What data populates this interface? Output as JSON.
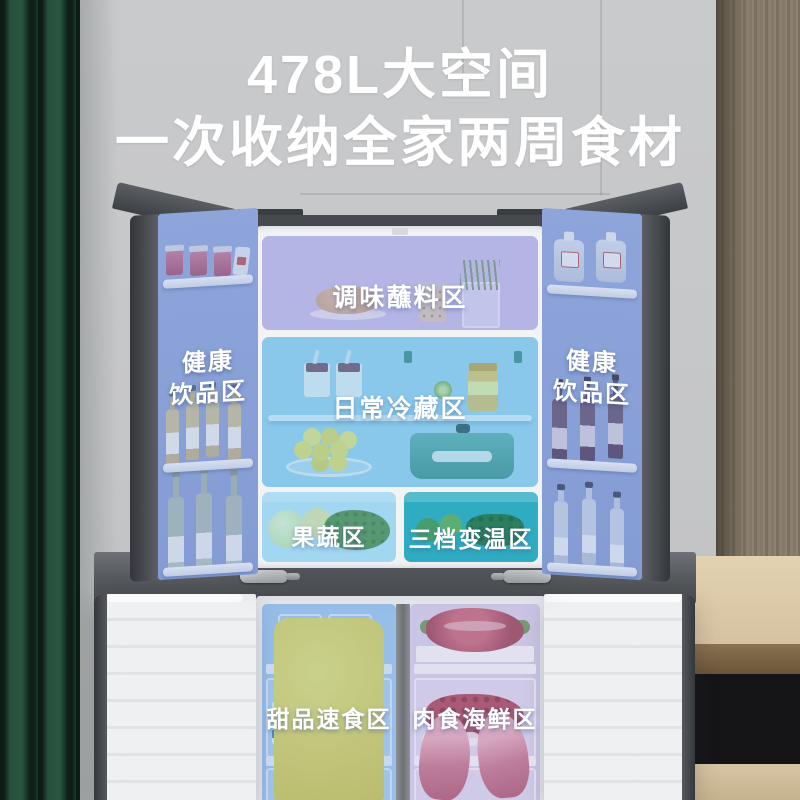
{
  "title": {
    "line1": "478L大空间",
    "line2": "一次收纳全家两周食材"
  },
  "fridge": {
    "door_left": {
      "label_top": "健康",
      "label_bottom": "饮品区"
    },
    "door_right": {
      "label_top": "健康",
      "label_bottom": "饮品区"
    },
    "zone_seasoning": {
      "label": "调味蘸料区"
    },
    "zone_daily": {
      "label": "日常冷藏区"
    },
    "zone_produce": {
      "label": "果蔬区"
    },
    "zone_variable": {
      "label": "三档变温区"
    },
    "zone_dessert": {
      "label": "甜品速食区"
    },
    "zone_meat": {
      "label": "肉食海鲜区"
    }
  },
  "colors": {
    "headline_text": "#ffffff",
    "wall_gray": "#c5c6c8",
    "curtain_green": "#2a5640",
    "wood_brown": "#8a7f6e",
    "door_dark_gray": "#42454a",
    "overlay_door_blue": "#8ca2d4",
    "overlay_lavender": "#c7c8ea",
    "overlay_daily_blue": "#9ed3ee",
    "overlay_produce_blue": "#b2e0f3",
    "overlay_variable_teal": "#39b2c6",
    "overlay_freezer_blue": "#a9cbee",
    "overlay_freezer_lavender": "#d3cde8"
  }
}
